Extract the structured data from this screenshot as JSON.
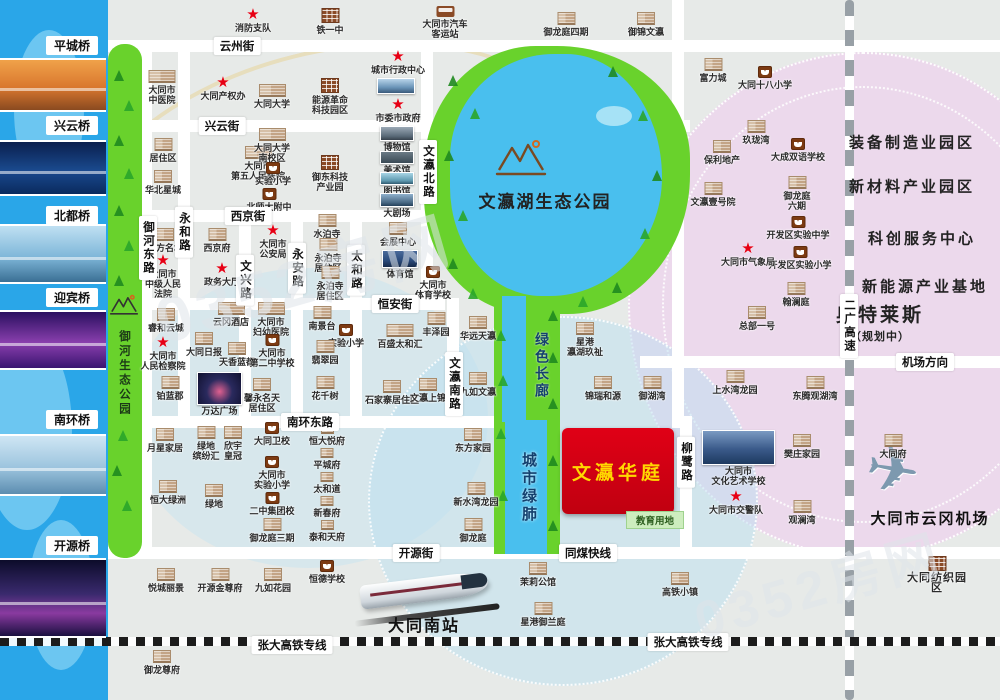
{
  "watermark": {
    "text": "0352房网"
  },
  "project": {
    "name": "文瀛华庭",
    "education": "教育用地"
  },
  "lake": {
    "name": "文瀛湖生态公园"
  },
  "river_park": {
    "name": "御河生态公园"
  },
  "corridor": {
    "green": "绿色长廊",
    "lung": "城市绿肺"
  },
  "stations": {
    "south": "大同南站",
    "airport": "大同市云冈机场"
  },
  "colors": {
    "project_red": "#d40012",
    "project_text": "#ffd800",
    "park_green": "#69d22c",
    "lake_blue": "#49bfee",
    "river_blue": "#2aa6e8",
    "zone_pink": "#ecd9ec",
    "star_red": "#e60014"
  },
  "bridges": [
    {
      "name": "平城桥",
      "label_y": 36,
      "photo_y": 58,
      "photo_h": 54,
      "tone": "b-orange"
    },
    {
      "name": "兴云桥",
      "label_y": 116,
      "photo_y": 140,
      "photo_h": 56,
      "tone": "b-night"
    },
    {
      "name": "北都桥",
      "label_y": 206,
      "photo_y": 224,
      "photo_h": 60,
      "tone": "b-day"
    },
    {
      "name": "迎宾桥",
      "label_y": 288,
      "photo_y": 310,
      "photo_h": 60,
      "tone": "b-purple"
    },
    {
      "name": "南环桥",
      "label_y": 410,
      "photo_y": 434,
      "photo_h": 62,
      "tone": "b-day2"
    },
    {
      "name": "开源桥",
      "label_y": 536,
      "photo_y": 558,
      "photo_h": 80,
      "tone": "b-night2"
    }
  ],
  "road_labels": [
    {
      "t": "云州街",
      "x": 237,
      "y": 46
    },
    {
      "t": "兴云街",
      "x": 222,
      "y": 126
    },
    {
      "t": "西京街",
      "x": 248,
      "y": 216
    },
    {
      "t": "恒安街",
      "x": 395,
      "y": 304
    },
    {
      "t": "南环东路",
      "x": 310,
      "y": 422
    },
    {
      "t": "开源街",
      "x": 416,
      "y": 553
    },
    {
      "t": "同煤快线",
      "x": 588,
      "y": 553
    },
    {
      "t": "机场方向",
      "x": 925,
      "y": 362
    },
    {
      "t": "张大高铁专线",
      "x": 292,
      "y": 645
    },
    {
      "t": "张大高铁专线",
      "x": 688,
      "y": 642
    },
    {
      "t": "御河东路",
      "x": 148,
      "y": 248,
      "v": 1
    },
    {
      "t": "永和路",
      "x": 184,
      "y": 232,
      "v": 1
    },
    {
      "t": "文兴路",
      "x": 245,
      "y": 280,
      "v": 1
    },
    {
      "t": "永安路",
      "x": 297,
      "y": 268,
      "v": 1
    },
    {
      "t": "太和路",
      "x": 356,
      "y": 270,
      "v": 1
    },
    {
      "t": "文瀛北路",
      "x": 428,
      "y": 172,
      "v": 1
    },
    {
      "t": "文瀛南路",
      "x": 454,
      "y": 384,
      "v": 1
    },
    {
      "t": "柳鹭路",
      "x": 686,
      "y": 462,
      "v": 1
    },
    {
      "t": "二广高速",
      "x": 849,
      "y": 326,
      "v": 1
    }
  ],
  "zones": [
    {
      "t": "装备制造业园区",
      "x": 912,
      "y": 142
    },
    {
      "t": "新材料产业园区",
      "x": 912,
      "y": 186
    },
    {
      "t": "科创服务中心",
      "x": 922,
      "y": 238
    },
    {
      "t": "新能源产业基地",
      "x": 925,
      "y": 286
    },
    {
      "t": "奥特莱斯",
      "x": 880,
      "y": 322,
      "big": 1,
      "sub": "（规划中）"
    }
  ],
  "pois": [
    {
      "t": "消防支队",
      "x": 253,
      "y": 8,
      "i": "star"
    },
    {
      "t": "铁一中",
      "x": 330,
      "y": 8,
      "i": "factory"
    },
    {
      "t": "大同市汽车\n客运站",
      "x": 445,
      "y": 6,
      "i": "bus"
    },
    {
      "t": "御龙庭四期",
      "x": 566,
      "y": 12,
      "i": "bld"
    },
    {
      "t": "御锦文瀛",
      "x": 646,
      "y": 12,
      "i": "bld"
    },
    {
      "t": "大同市\n中医院",
      "x": 162,
      "y": 70,
      "i": "bldw"
    },
    {
      "t": "大同产权办",
      "x": 223,
      "y": 76,
      "i": "star"
    },
    {
      "t": "城市行政中心",
      "x": 398,
      "y": 50,
      "i": "star"
    },
    {
      "t": "大同大学",
      "x": 272,
      "y": 84,
      "i": "bldw"
    },
    {
      "t": "能源革命\n科技园区",
      "x": 330,
      "y": 78,
      "i": "factory"
    },
    {
      "t": "市委市政府",
      "x": 398,
      "y": 98,
      "i": "star"
    },
    {
      "t": "居住区",
      "x": 163,
      "y": 138,
      "i": "bld"
    },
    {
      "t": "华北星城",
      "x": 163,
      "y": 170,
      "i": "bld"
    },
    {
      "t": "大同市\n第五人民医院",
      "x": 258,
      "y": 146,
      "i": "bldw"
    },
    {
      "t": "大同大学\n南校区",
      "x": 272,
      "y": 128,
      "i": "bldw"
    },
    {
      "t": "实验小学",
      "x": 273,
      "y": 162,
      "i": "school"
    },
    {
      "t": "北师大附中",
      "x": 269,
      "y": 188,
      "i": "school"
    },
    {
      "t": "御东科技\n产业园",
      "x": 330,
      "y": 155,
      "i": "factory"
    },
    {
      "t": "水泊寺",
      "x": 327,
      "y": 214,
      "i": "bld"
    },
    {
      "t": "东方名城",
      "x": 165,
      "y": 228,
      "i": "bld"
    },
    {
      "t": "大同市\n中级人民\n法院",
      "x": 163,
      "y": 254,
      "i": "star"
    },
    {
      "t": "西京府",
      "x": 217,
      "y": 228,
      "i": "bld"
    },
    {
      "t": "政务大厅",
      "x": 222,
      "y": 262,
      "i": "star"
    },
    {
      "t": "大同市\n公安局",
      "x": 273,
      "y": 224,
      "i": "star"
    },
    {
      "t": "永泊寺\n居住区",
      "x": 328,
      "y": 238,
      "i": "bld"
    },
    {
      "t": "永泊寺\n居住区",
      "x": 330,
      "y": 266,
      "i": "bld"
    },
    {
      "t": "会展中心",
      "x": 398,
      "y": 222,
      "i": "bld"
    },
    {
      "t": "大同市\n体育学校",
      "x": 433,
      "y": 266,
      "i": "school"
    },
    {
      "t": "睿和云城",
      "x": 166,
      "y": 308,
      "i": "bld"
    },
    {
      "t": "大同市\n人民检察院",
      "x": 163,
      "y": 336,
      "i": "star"
    },
    {
      "t": "云冈酒店",
      "x": 231,
      "y": 302,
      "i": "bldw"
    },
    {
      "t": "大同日报",
      "x": 204,
      "y": 332,
      "i": "bld"
    },
    {
      "t": "天香蓝都",
      "x": 237,
      "y": 342,
      "i": "bld"
    },
    {
      "t": "铂蓝郡",
      "x": 170,
      "y": 376,
      "i": "bld"
    },
    {
      "t": "大同市\n妇幼医院",
      "x": 271,
      "y": 302,
      "i": "bldw"
    },
    {
      "t": "大同市\n第二中学校",
      "x": 272,
      "y": 334,
      "i": "school"
    },
    {
      "t": "南景台",
      "x": 322,
      "y": 306,
      "i": "bld"
    },
    {
      "t": "实验小学",
      "x": 346,
      "y": 324,
      "i": "school"
    },
    {
      "t": "翡翠园",
      "x": 325,
      "y": 340,
      "i": "bld"
    },
    {
      "t": "馨永名天\n居住区",
      "x": 262,
      "y": 378,
      "i": "bld"
    },
    {
      "t": "花千树",
      "x": 325,
      "y": 376,
      "i": "bld"
    },
    {
      "t": "石家寨居住区",
      "x": 392,
      "y": 380,
      "i": "bld"
    },
    {
      "t": "文瀛上锦",
      "x": 428,
      "y": 378,
      "i": "bld"
    },
    {
      "t": "百盛太和汇",
      "x": 400,
      "y": 324,
      "i": "bldw"
    },
    {
      "t": "丰泽园",
      "x": 436,
      "y": 312,
      "i": "bld"
    },
    {
      "t": "华远天瀛",
      "x": 478,
      "y": 316,
      "i": "bld"
    },
    {
      "t": "九如文瀛",
      "x": 478,
      "y": 372,
      "i": "bld"
    },
    {
      "t": "星港\n瀛湖玖祉",
      "x": 585,
      "y": 322,
      "i": "bld"
    },
    {
      "t": "锦瑞和源",
      "x": 603,
      "y": 376,
      "i": "bld"
    },
    {
      "t": "御湖湾",
      "x": 652,
      "y": 376,
      "i": "bld"
    },
    {
      "t": "富力城",
      "x": 713,
      "y": 58,
      "i": "bld"
    },
    {
      "t": "大同十八小学",
      "x": 765,
      "y": 66,
      "i": "school"
    },
    {
      "t": "玖珑湾",
      "x": 756,
      "y": 120,
      "i": "bld"
    },
    {
      "t": "大成双语学校",
      "x": 798,
      "y": 138,
      "i": "school"
    },
    {
      "t": "御龙庭\n六期",
      "x": 797,
      "y": 176,
      "i": "bld"
    },
    {
      "t": "开发区实验中学",
      "x": 798,
      "y": 216,
      "i": "school"
    },
    {
      "t": "开发区实验小学",
      "x": 800,
      "y": 246,
      "i": "school"
    },
    {
      "t": "大同市气象局",
      "x": 748,
      "y": 242,
      "i": "star"
    },
    {
      "t": "翰澜庭",
      "x": 796,
      "y": 282,
      "i": "bld"
    },
    {
      "t": "保利地产",
      "x": 722,
      "y": 140,
      "i": "bld"
    },
    {
      "t": "文瀛壹号院",
      "x": 713,
      "y": 182,
      "i": "bld"
    },
    {
      "t": "总部一号",
      "x": 757,
      "y": 306,
      "i": "bld"
    },
    {
      "t": "东腾观湖湾",
      "x": 815,
      "y": 376,
      "i": "bld"
    },
    {
      "t": "上水湾龙园",
      "x": 735,
      "y": 370,
      "i": "bld"
    },
    {
      "t": "月星家居",
      "x": 165,
      "y": 428,
      "i": "bld"
    },
    {
      "t": "绿地\n缤纷汇",
      "x": 206,
      "y": 426,
      "i": "bld"
    },
    {
      "t": "欣宇\n皇冠",
      "x": 233,
      "y": 426,
      "i": "bld"
    },
    {
      "t": "恒大绿洲",
      "x": 168,
      "y": 480,
      "i": "bld"
    },
    {
      "t": "绿地",
      "x": 214,
      "y": 484,
      "i": "bld"
    },
    {
      "t": "大同卫校",
      "x": 272,
      "y": 422,
      "i": "school"
    },
    {
      "t": "大同市\n实验小学",
      "x": 272,
      "y": 456,
      "i": "school"
    },
    {
      "t": "二中集团校",
      "x": 272,
      "y": 492,
      "i": "school"
    },
    {
      "t": "御龙庭三期",
      "x": 272,
      "y": 518,
      "i": "bld"
    },
    {
      "t": "恒大悦府",
      "x": 327,
      "y": 424,
      "i": "blds"
    },
    {
      "t": "平城府",
      "x": 327,
      "y": 448,
      "i": "blds"
    },
    {
      "t": "太和道",
      "x": 327,
      "y": 472,
      "i": "blds"
    },
    {
      "t": "新春府",
      "x": 327,
      "y": 496,
      "i": "blds"
    },
    {
      "t": "泰和天府",
      "x": 327,
      "y": 520,
      "i": "blds"
    },
    {
      "t": "东方家园",
      "x": 473,
      "y": 428,
      "i": "bld"
    },
    {
      "t": "新水湾龙园",
      "x": 476,
      "y": 482,
      "i": "bld"
    },
    {
      "t": "御龙庭",
      "x": 473,
      "y": 518,
      "i": "bld"
    },
    {
      "t": "樊庄家园",
      "x": 802,
      "y": 434,
      "i": "bld"
    },
    {
      "t": "观澜湾",
      "x": 802,
      "y": 500,
      "i": "bld"
    },
    {
      "t": "大同市交警队",
      "x": 736,
      "y": 490,
      "i": "star"
    },
    {
      "t": "大同府",
      "x": 893,
      "y": 434,
      "i": "bld"
    },
    {
      "t": "悦城丽景",
      "x": 166,
      "y": 568,
      "i": "bld"
    },
    {
      "t": "开源金尊府",
      "x": 220,
      "y": 568,
      "i": "bld"
    },
    {
      "t": "九如花园",
      "x": 273,
      "y": 568,
      "i": "bld"
    },
    {
      "t": "恒德学校",
      "x": 327,
      "y": 560,
      "i": "school"
    },
    {
      "t": "茉莉公馆",
      "x": 538,
      "y": 562,
      "i": "bld"
    },
    {
      "t": "星港御兰庭",
      "x": 543,
      "y": 602,
      "i": "bld"
    },
    {
      "t": "高铁小镇",
      "x": 680,
      "y": 572,
      "i": "bld"
    },
    {
      "t": "大同纺织园区",
      "x": 937,
      "y": 556,
      "i": "factory",
      "big": 1
    },
    {
      "t": "御龙尊府",
      "x": 162,
      "y": 650,
      "i": "bld"
    }
  ],
  "photos": [
    {
      "t": "",
      "x": 377,
      "y": 78,
      "w": 38,
      "h": 16,
      "c": "p-sky"
    },
    {
      "t": "博物馆",
      "x": 380,
      "y": 126,
      "w": 34,
      "h": 15,
      "c": "p-museum"
    },
    {
      "t": "美术馆",
      "x": 380,
      "y": 151,
      "w": 34,
      "h": 13,
      "c": "p-art"
    },
    {
      "t": "图书馆",
      "x": 380,
      "y": 172,
      "w": 34,
      "h": 13,
      "c": "p-lib"
    },
    {
      "t": "大剧场",
      "x": 380,
      "y": 193,
      "w": 34,
      "h": 14,
      "c": "p-theater"
    },
    {
      "t": "体育馆",
      "x": 382,
      "y": 250,
      "w": 36,
      "h": 18,
      "c": "p-stadium"
    },
    {
      "t": "万达广场",
      "x": 197,
      "y": 372,
      "w": 45,
      "h": 33,
      "c": "p-wanda"
    },
    {
      "t": "大同市\n文化艺术学校",
      "x": 702,
      "y": 430,
      "w": 73,
      "h": 35,
      "c": "p-school"
    }
  ]
}
